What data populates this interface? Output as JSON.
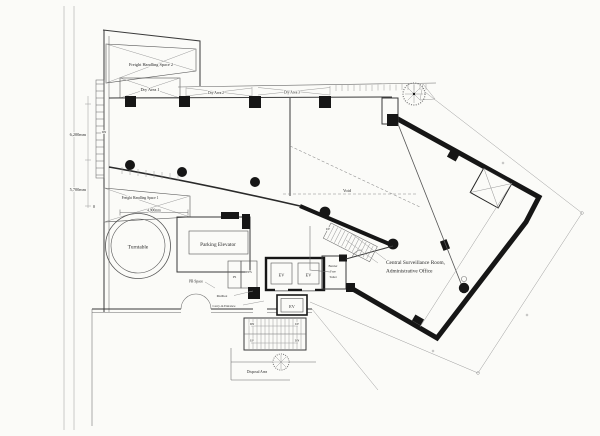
{
  "labels": {
    "freight_handling_space_2": "Freight Handling Space 2",
    "dry_area_1": "Dry Area 1",
    "dry_area_2": "Dry Area 2",
    "dry_area_3": "Dry Area 3",
    "freight_handling_space_1": "Freight Handling Space 1",
    "turntable": "Turntable",
    "parking_elevator": "Parking Elevator",
    "pb_space": "PB Space",
    "ps": "PS",
    "eps": "EPS",
    "mailbox": "Mailbox",
    "carry_in_entrance": "Carry-in Entrance",
    "ev": "EV",
    "barrier_free_toilet_line1": "Barrier",
    "barrier_free_toilet_line2": "Free",
    "barrier_free_toilet_line3": "Toilet",
    "void": "Void",
    "central_line1": "Central Surveillance Room,",
    "central_line2": "Administrative Office",
    "disposal_area": "Disposal Area",
    "up": "UP",
    "dn": "DN"
  },
  "dimensions": {
    "left_upper": "6,200mm",
    "left_lower": "5,700mm",
    "left_origin": "0",
    "freight1_width": "4,900mm"
  },
  "colors": {
    "paper": "#fbfbf8",
    "ink": "#161616",
    "line_gray": "#6a6a6a",
    "faint_gray": "#9a9a9a"
  }
}
